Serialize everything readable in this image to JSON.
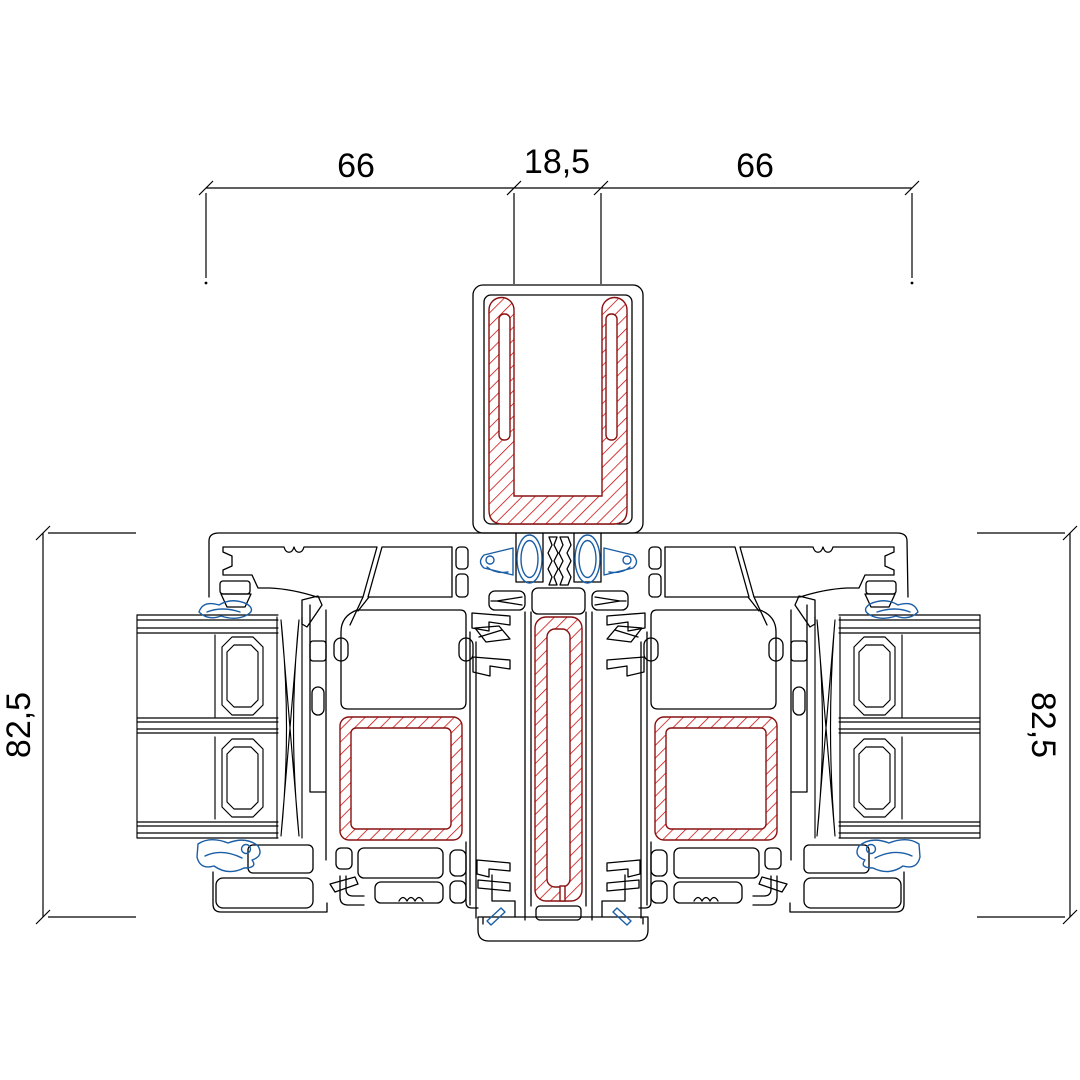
{
  "page": {
    "background": "#ffffff"
  },
  "drawing": {
    "type": "window-mullion-cross-section",
    "dimensions": {
      "top": {
        "left": "66",
        "center": "18,5",
        "right": "66"
      },
      "left_side": "82,5",
      "right_side": "82,5"
    },
    "colors": {
      "outline": "#000000",
      "steel_hatch": "#cc0000",
      "steel_outline": "#8a1010",
      "gasket_blue": "#1b5ea6",
      "background": "#ffffff"
    }
  }
}
